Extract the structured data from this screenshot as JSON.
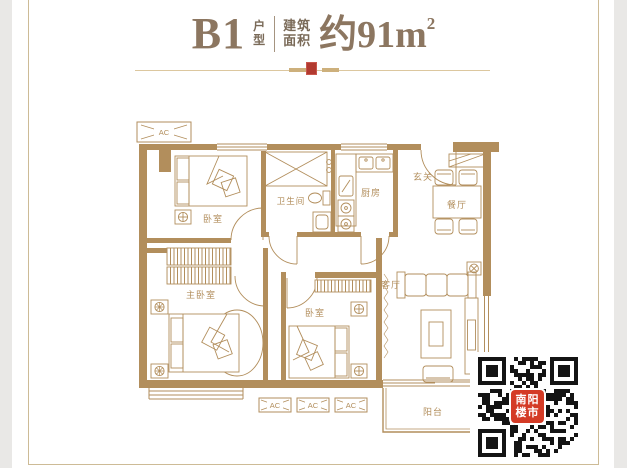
{
  "title": {
    "model": "B1",
    "model_suffix": [
      "户",
      "型"
    ],
    "area_prefix": [
      "建筑",
      "面积"
    ],
    "area": "约91m",
    "area_exp": "2"
  },
  "plan": {
    "color": "#b28e5c",
    "labels": {
      "bedroom1": "卧室",
      "bathroom": "卫生间",
      "kitchen": "厨房",
      "foyer": "玄关",
      "dining": "餐厅",
      "master": "主卧室",
      "bedroom2": "卧室",
      "living": "客厅",
      "balcony": "阳台"
    },
    "ac": "AC"
  },
  "qr": {
    "seal_lines": [
      "南阳",
      "楼市"
    ],
    "dark": "#141414",
    "seal_bg": "#d43b26"
  },
  "colors": {
    "accent_red": "#b23a30",
    "line": "#b28e5c",
    "frame": "#cdbb96",
    "title_text": "#8c7660"
  }
}
